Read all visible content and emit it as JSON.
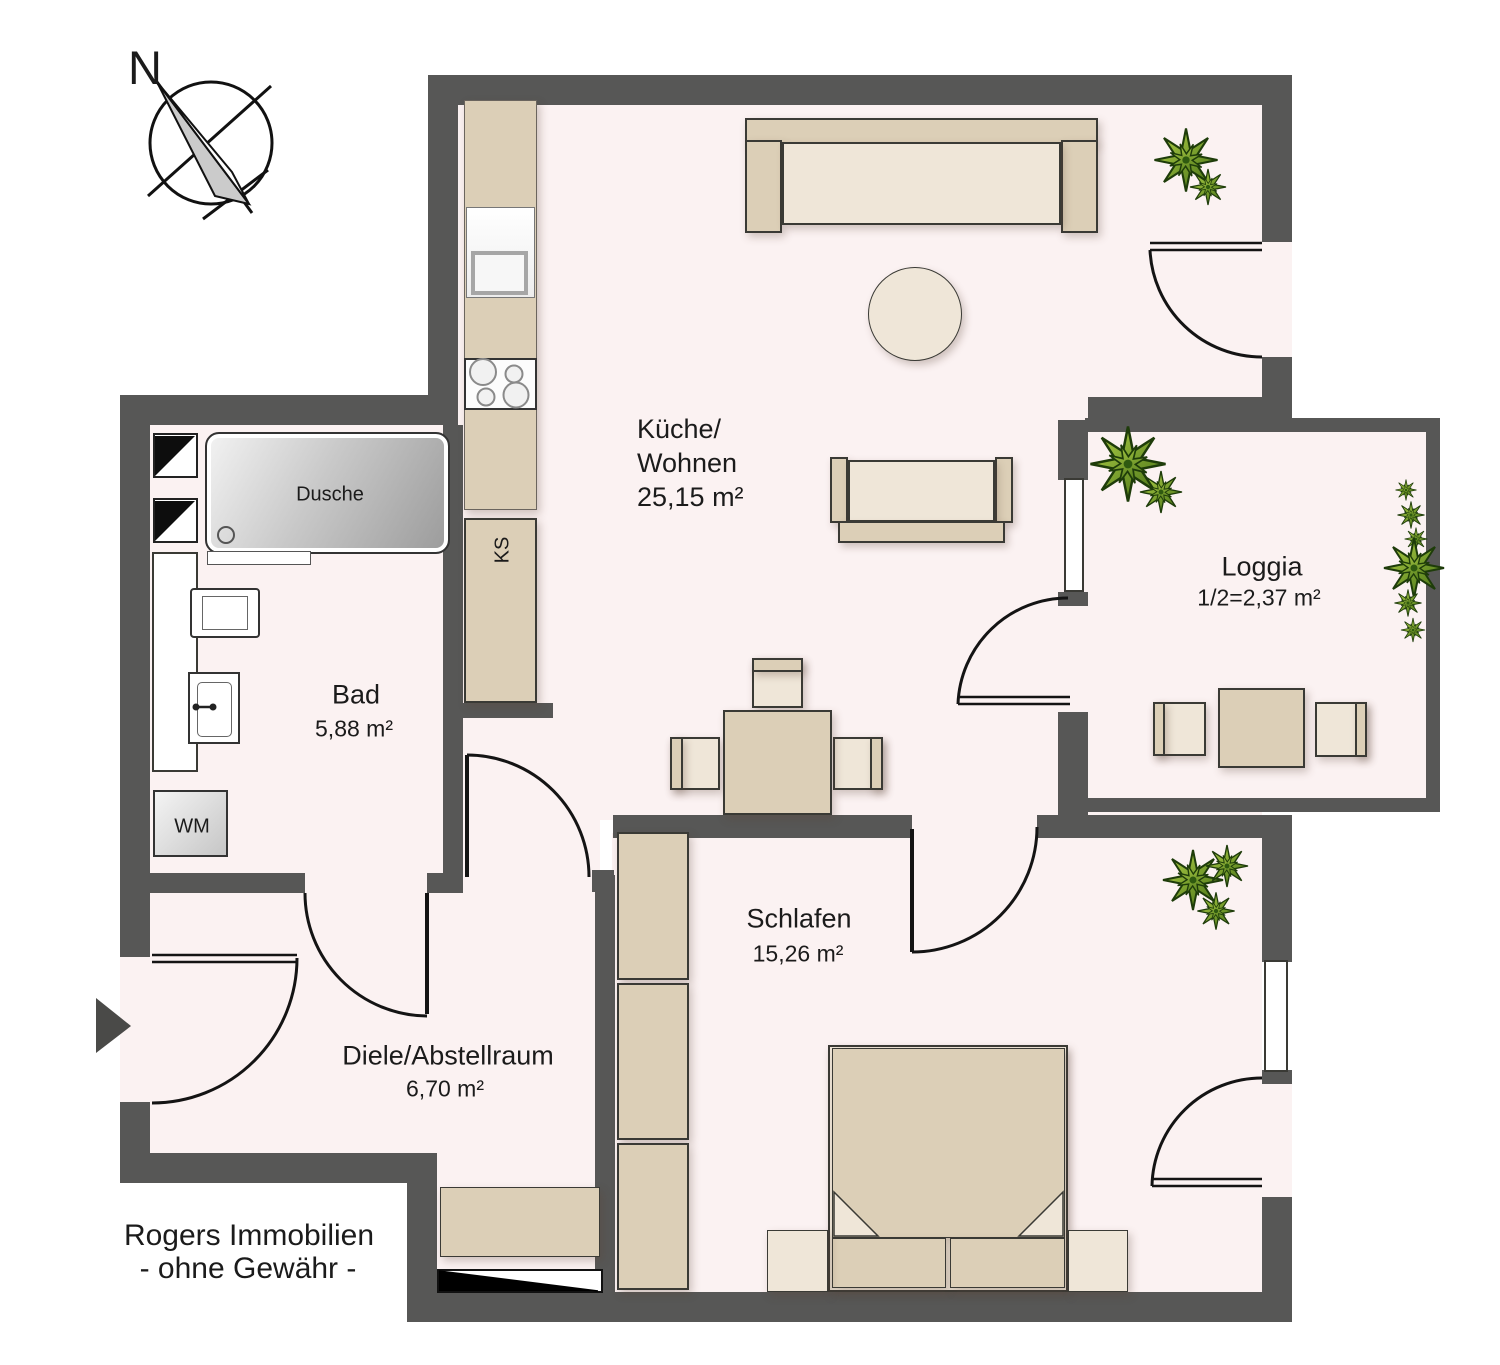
{
  "compass": {
    "north": "N"
  },
  "rooms": {
    "kueche_wohnen": {
      "name_line1": "Küche/",
      "name_line2": "Wohnen",
      "area": "25,15 m²"
    },
    "bad": {
      "name": "Bad",
      "area": "5,88 m²"
    },
    "diele": {
      "name": "Diele/Abstellraum",
      "area": "6,70 m²"
    },
    "schlafen": {
      "name": "Schlafen",
      "area": "15,26 m²"
    },
    "loggia": {
      "name": "Loggia",
      "area": "1/2=2,37 m²"
    }
  },
  "fixtures": {
    "shower": "Dusche",
    "washing_machine": "WM",
    "fridge": "KS"
  },
  "footer": {
    "line1": "Rogers Immobilien",
    "line2": "- ohne Gewähr -"
  },
  "colors": {
    "wall": "#575756",
    "floor": "#fbf2f2",
    "furniture": "#dccfb7",
    "furniture_light": "#efe6d8",
    "outline": "#3a3a35",
    "plant_light": "#b5d44a",
    "plant_dark": "#3f6b12"
  }
}
